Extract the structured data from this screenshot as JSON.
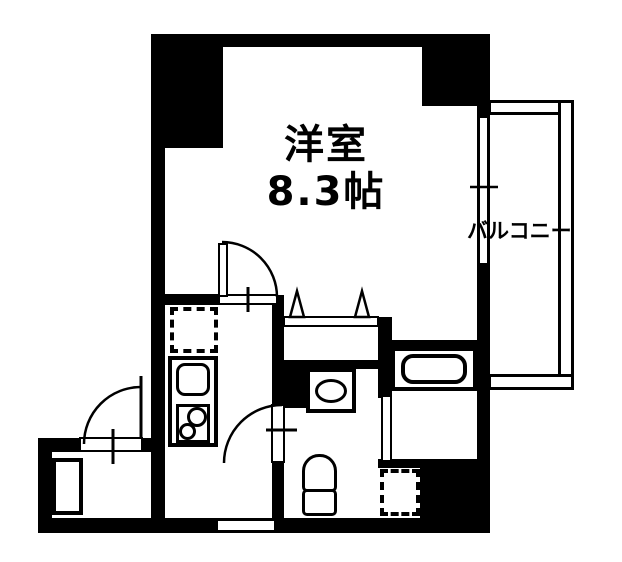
{
  "floorplan": {
    "room": {
      "name": "洋室",
      "size": "8.3帖"
    },
    "balcony": {
      "name": "バルコニー"
    },
    "colors": {
      "line": "#000000",
      "background": "#ffffff"
    },
    "symbols": {
      "entry_door": "outward-swing-door-arc",
      "living_room_door": "swing-door-arc",
      "washroom_door": "swing-door-arc",
      "closet_front": "two-fold-door-triangles",
      "balcony_window": "double-line-sliding-window",
      "kitchen": "sink-and-two-burner-stove",
      "refrigerator_space": "dashed-square",
      "washing_machine_space": "dashed-square",
      "bathtub": "rounded-rect-tub",
      "toilet": "tank-and-bowl",
      "washbasin": "square-with-oval-bowl",
      "shoe_cabinet": "outlined-rectangle"
    }
  }
}
